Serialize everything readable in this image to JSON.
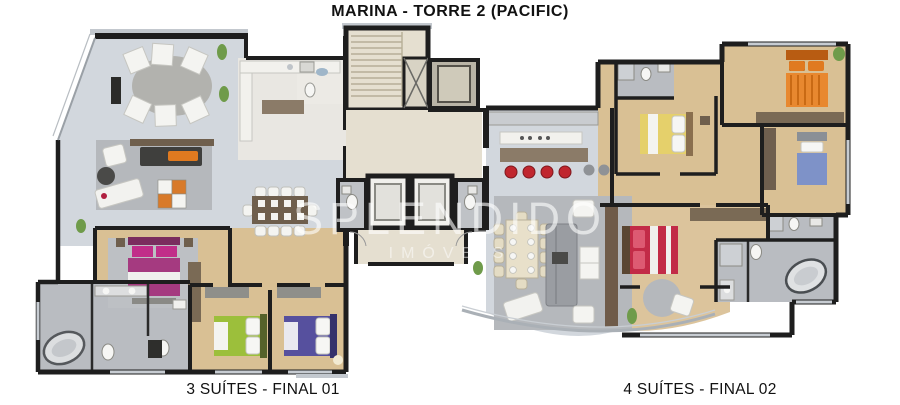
{
  "title": "MARINA - TORRE 2 (PACIFIC)",
  "watermark": {
    "line1": "SPLENDIDO",
    "line2": "IMÓVEIS"
  },
  "units": [
    {
      "id": "left",
      "label": "3 SUÍTES - FINAL 01"
    },
    {
      "id": "right",
      "label": "4 SUÍTES - FINAL 02"
    }
  ],
  "palette": {
    "wall": "#1e1e1e",
    "floor_living": "#d2d7dd",
    "floor_wood": "#d9c094",
    "floor_core": "#e5dfd0",
    "floor_bath": "#b9bcc1",
    "rug": "#b5b8bc",
    "bed_magenta": "#a53a80",
    "bed_green": "#9cbf3b",
    "bed_purple": "#56509e",
    "bed_orange": "#e8882f",
    "bed_yellow": "#e5d06b",
    "bed_blue": "#7e92c8",
    "bed_red": "#c22b47",
    "stool_red": "#c0262e",
    "furniture_white": "#f4f4f1",
    "furniture_brown": "#6f5f4d",
    "plant": "#6f9b4a"
  }
}
